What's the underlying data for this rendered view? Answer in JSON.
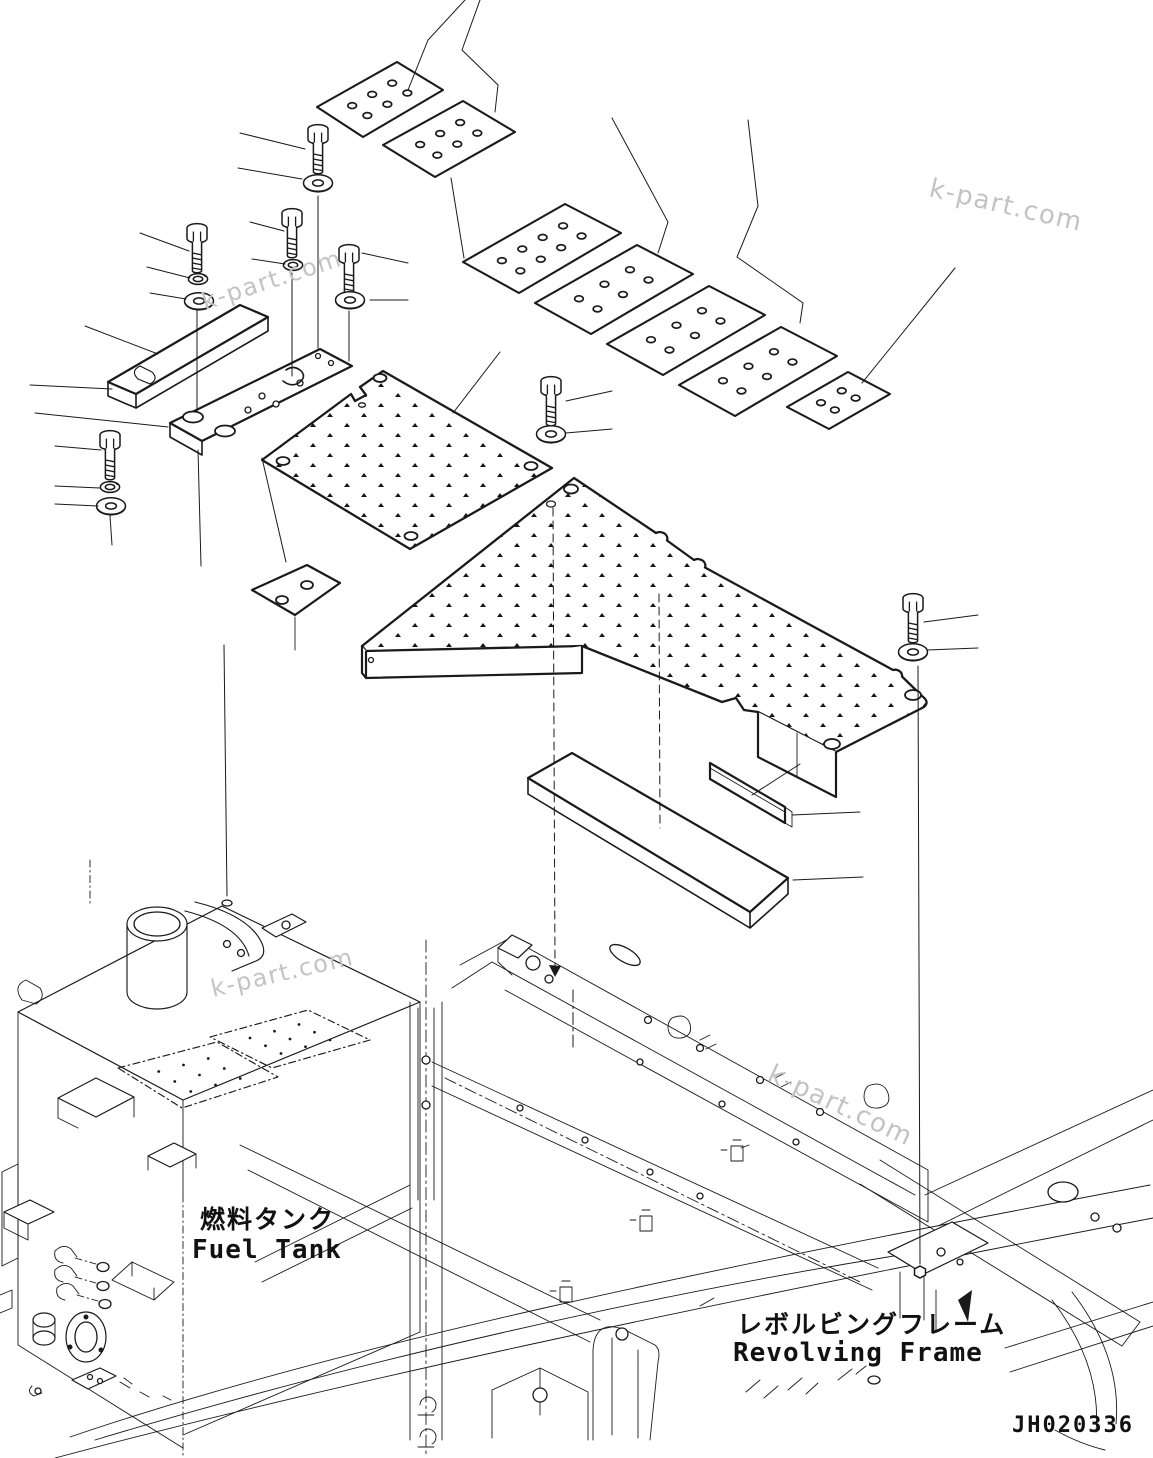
{
  "page": {
    "background": "#ffffff",
    "line_color": "#1a1a1a",
    "watermark_color": "#c3c3c3"
  },
  "watermark": {
    "text": "k-part.com"
  },
  "labels": {
    "fuel_tank_jp": "燃料タンク",
    "fuel_tank_en": "Fuel Tank",
    "revolving_frame_jp": "レボルビングフレーム",
    "revolving_frame_en": "Revolving Frame",
    "drawing_number": "JH020336"
  }
}
